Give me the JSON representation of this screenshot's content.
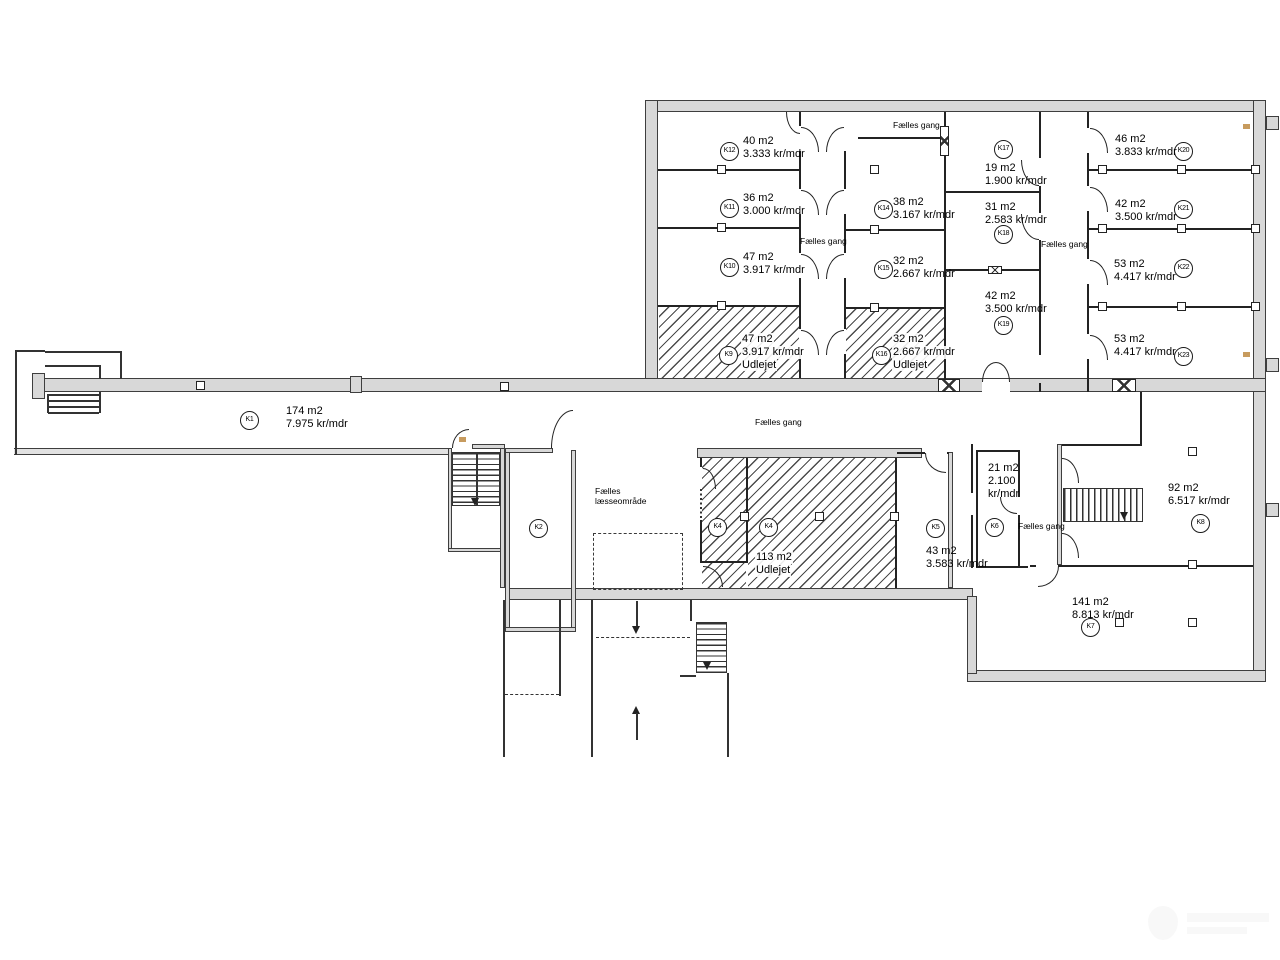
{
  "labels": {
    "faelles_gang": "Fælles gang",
    "faelles": "Fælles",
    "laesseomraade": "læsseområde"
  },
  "units": {
    "K1": {
      "id": "K1",
      "area": "174 m2",
      "rent": "7.975 kr/mdr"
    },
    "K2": {
      "id": "K2"
    },
    "K4": {
      "id": "K4",
      "area": "113 m2",
      "status": "Udlejet"
    },
    "K5": {
      "id": "K5",
      "area": "43 m2",
      "rent": "3.583 kr/mdr"
    },
    "K6": {
      "id": "K6",
      "area": "21 m2",
      "rent_l1": "2.100",
      "rent_l2": "kr/mdr"
    },
    "K7": {
      "id": "K7",
      "area": "141 m2",
      "rent": "8.813 kr/mdr"
    },
    "K8": {
      "id": "K8",
      "area": "92 m2",
      "rent": "6.517 kr/mdr"
    },
    "K9": {
      "id": "K9",
      "area": "47 m2",
      "rent": "3.917 kr/mdr",
      "status": "Udlejet"
    },
    "K10": {
      "id": "K10",
      "area": "47 m2",
      "rent": "3.917 kr/mdr"
    },
    "K11": {
      "id": "K11",
      "area": "36 m2",
      "rent": "3.000 kr/mdr"
    },
    "K12": {
      "id": "K12",
      "area": "40 m2",
      "rent": "3.333 kr/mdr"
    },
    "K14": {
      "id": "K14",
      "area": "38 m2",
      "rent": "3.167 kr/mdr"
    },
    "K15": {
      "id": "K15",
      "area": "32 m2",
      "rent": "2.667 kr/mdr"
    },
    "K16": {
      "id": "K16",
      "area": "32 m2",
      "rent": "2.667 kr/mdr",
      "status": "Udlejet"
    },
    "K17": {
      "id": "K17",
      "area": "19 m2",
      "rent": "1.900 kr/mdr"
    },
    "K18": {
      "id": "K18",
      "area": "31 m2",
      "rent": "2.583 kr/mdr"
    },
    "K19": {
      "id": "K19",
      "area": "42 m2",
      "rent": "3.500 kr/mdr"
    },
    "K20": {
      "id": "K20",
      "area": "46 m2",
      "rent": "3.833 kr/mdr"
    },
    "K21": {
      "id": "K21",
      "area": "42 m2",
      "rent": "3.500 kr/mdr"
    },
    "K22": {
      "id": "K22",
      "area": "53 m2",
      "rent": "4.417 kr/mdr"
    },
    "K23": {
      "id": "K23",
      "area": "53 m2",
      "rent": "4.417 kr/mdr"
    }
  }
}
